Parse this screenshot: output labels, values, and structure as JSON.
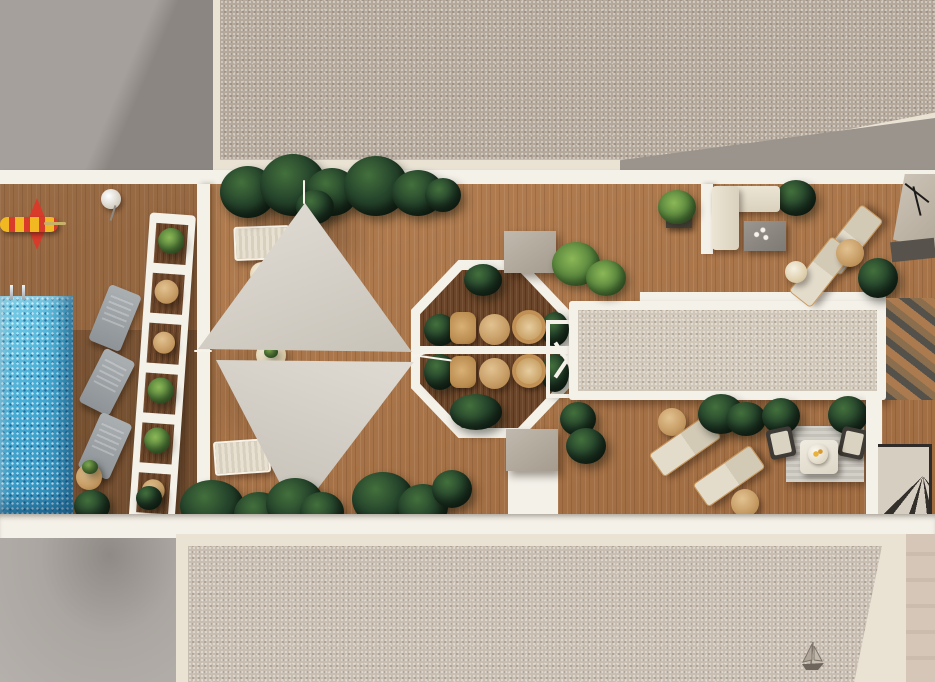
{
  "scene": {
    "title": "Rooftop terrace – top-down architectural 3D render",
    "view": "top-down plan",
    "text_visible": "none"
  },
  "palette": {
    "wall-gray": "#a5a09b",
    "wall-gray-shadow": "#8b8681",
    "cream": "#eae3d4",
    "white-wall": "#f4f1e9",
    "wood": "#ab7447",
    "wood-dark": "#6b4529",
    "pool": "#42aed6",
    "pool-deep": "#2b88b6",
    "sail": "#d6d1c8",
    "gravel": "#b4a89b",
    "gravel-light": "#d0c7b9",
    "bush-green": "#26452c",
    "palm-green": "#53803a",
    "lounger-gray": "#989da1",
    "lounger-beige": "#dbd3c0",
    "rattan": "#b98b4f",
    "toy-red": "#d93b2b",
    "toy-yellow": "#f2b822",
    "gray-lower-left": "#b0aba6",
    "pink-wall": "#d6c6b8"
  },
  "areas": [
    {
      "id": "pool-terrace",
      "label": "Pool terrace with gray sun loungers"
    },
    {
      "id": "sail-deck",
      "label": "Wood deck under twin shade sails"
    },
    {
      "id": "octagon-dining",
      "label": "Octagonal dining patio, two bistro sets"
    },
    {
      "id": "skylight-roof",
      "label": "Long gravel skylight roof"
    },
    {
      "id": "sofa-corner",
      "label": "L-sofa lounge corner"
    },
    {
      "id": "sunbed-corner",
      "label": "Beige sunbed corner"
    },
    {
      "id": "rug-lounge",
      "label": "Striped rug lounge with armchairs"
    },
    {
      "id": "stair-access",
      "label": "Winder stair roof access"
    }
  ],
  "objects": {
    "pool": {
      "label": "Swimming pool",
      "ladder": true
    },
    "float_toy": {
      "label": "Red-yellow inflatable float"
    },
    "shade_sails": {
      "label": "Triangular shade sails",
      "count": 2
    },
    "ladder_shelf": {
      "label": "White ladder shelf with plants"
    },
    "sun_loungers_gray": {
      "count": 3
    },
    "sun_loungers_white": {
      "count": 2
    },
    "sun_loungers_beige": {
      "count": 4
    },
    "dining_sets": {
      "count": 2,
      "chairs_per_set": 2,
      "tables": 2
    },
    "side_tables": {
      "count": 7
    },
    "l_sofa": {
      "label": "L-shaped cream sofa"
    },
    "coffee_table": {
      "label": "Gray coffee table with candles"
    },
    "rug": {
      "label": "Striped outdoor rug"
    },
    "armchairs_dark": {
      "count": 2
    },
    "white_loveseat": {
      "label": "White loveseat with tray"
    },
    "planters_bushes": {
      "count": 22
    },
    "palms": {
      "count": 3
    },
    "chimney_blocks": {
      "count": 2
    },
    "stairs": {
      "label": "Dark winder staircase"
    },
    "antenna": {
      "label": "TV antenna on neighbor roof"
    },
    "sailboat_motif": {
      "label": "Small sailboat mark on lower roof"
    }
  }
}
